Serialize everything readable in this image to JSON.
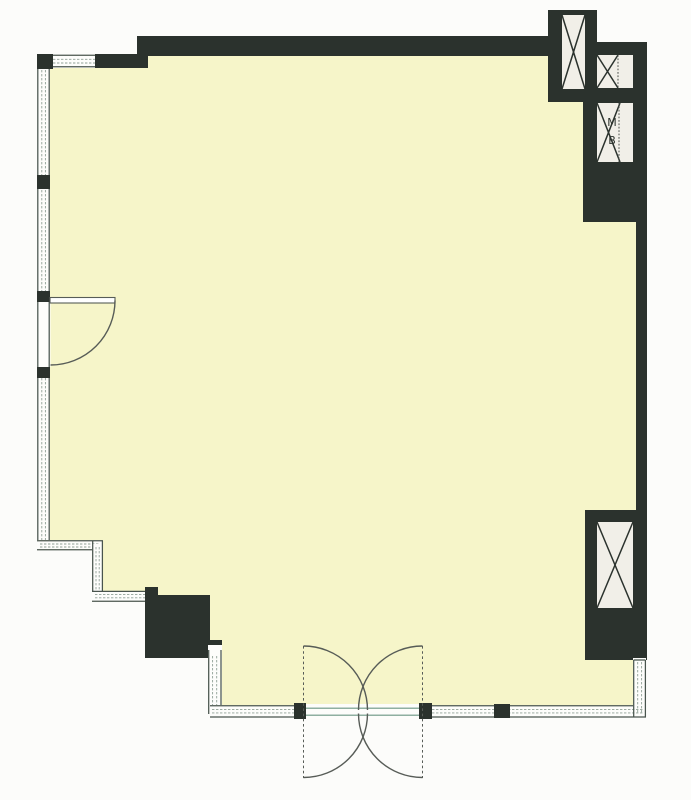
{
  "plan": {
    "type": "architectural-floor-plan",
    "room": {
      "name": "open-plan-room",
      "floor_finish": "pale-yellow"
    },
    "annotations": {
      "shaft_label_line1": "M",
      "shaft_label_line2": "B"
    },
    "icons": {
      "shaft_cross": "diagonal-cross-shaft-symbol",
      "door_swing": "quarter-circle-door-swing",
      "double_door_swing": "double-acting-double-door-butterfly"
    },
    "colors": {
      "outside": "#fcfcfa",
      "floor": "#f6f5c9",
      "wall": "#2b322d",
      "shaft_bg": "#f1efe8",
      "glazing_dark": "#49544d",
      "glazing_mid": "#90a096",
      "glazing_teal": "#8fb0a1",
      "door_stroke": "#575c57",
      "divider": "#4a4f4a",
      "label_ink": "#2e352f"
    }
  }
}
